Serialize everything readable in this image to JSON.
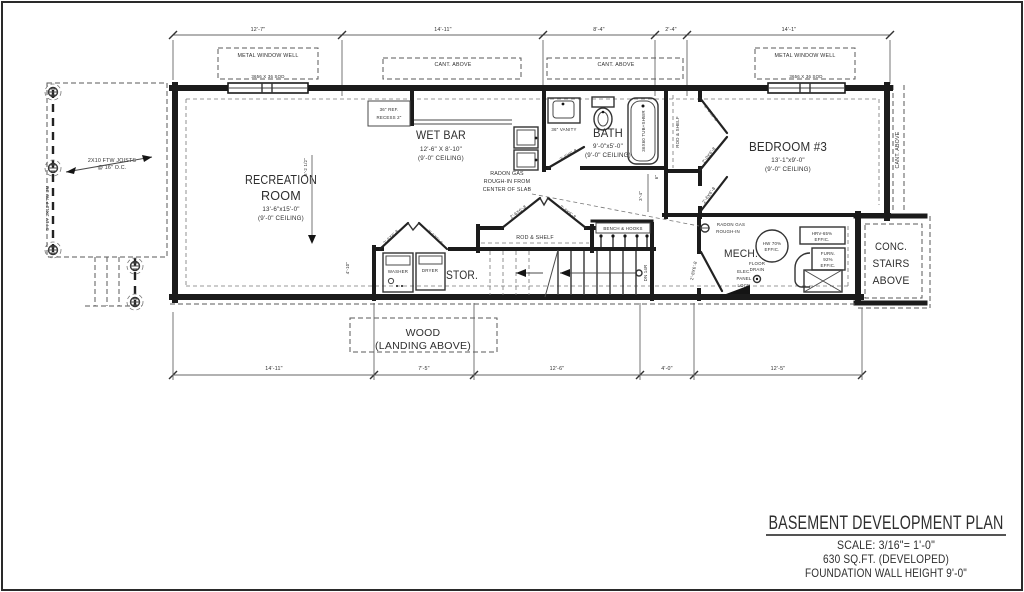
{
  "title_block": {
    "title": "BASEMENT DEVELOPMENT PLAN",
    "scale": "SCALE: 3/16\"= 1'-0\"",
    "area": "630 SQ.FT. (DEVELOPED)",
    "wall_height": "FOUNDATION WALL HEIGHT 9'-0\""
  },
  "dims": {
    "top": [
      "12'-7\"",
      "14'-11\"",
      "8'-4\"",
      "2'-4\"",
      "14'-1\""
    ],
    "bottom": [
      "14'-11\"",
      "7'-5\"",
      "12'-6\"",
      "4'-0\"",
      "12'-5\""
    ],
    "rec_height": "8'-2 1/2\"",
    "stor_width": "4'-10\"",
    "hall": "3'-4\"",
    "six": "6\""
  },
  "rooms": {
    "recreation": {
      "line1": "RECREATION",
      "line2": "ROOM",
      "size": "13'-6\"x15'-0\"",
      "ceiling": "(9'-0\" CEILING)"
    },
    "wetbar": {
      "name": "WET BAR",
      "size": "12'-6\" X 8'-10\"",
      "ceiling": "(9'-0\" CEILING)"
    },
    "bath": {
      "name": "BATH",
      "size": "9'-0\"x5'-0\"",
      "ceiling": "(9'-0\" CEILING)"
    },
    "bedroom": {
      "name": "BEDROOM #3",
      "size": "13'-1\"x9'-0\"",
      "ceiling": "(9'-0\" CEILING)"
    },
    "mech": {
      "name": "MECH."
    },
    "stor": {
      "name": "STOR."
    }
  },
  "ann": {
    "metal_window_well": "METAL WINDOW WELL",
    "cant_above": "CANT. ABOVE",
    "window_size": "3656 X 36 SOD",
    "joists_1": "2X10 FTW JOISTS",
    "joists_2": "@ 16\" O.C.",
    "beam": "3 PLY 2X10 FTW BM",
    "radon_slab_1": "RADON GAS",
    "radon_slab_2": "ROUGH-IN FROM",
    "radon_slab_3": "CENTER OF SLAB",
    "radon_mech_1": "RADON GAS",
    "radon_mech_2": "ROUGH-IN",
    "wood_1": "WOOD",
    "wood_2": "(LANDING ABOVE)",
    "conc_1": "CONC.",
    "conc_2": "STAIRS",
    "conc_3": "ABOVE",
    "dn": "DN 14R",
    "ref_1": "36\" REF.",
    "ref_2": "RECESS 2\"",
    "vanity": "36\" VANITY",
    "tub": "36X60 TUB+SHWR",
    "rod_shelf": "ROD & SHELF",
    "bench_hooks": "BENCH & HOOKS",
    "washer": "WASHER",
    "dryer": "DRYER",
    "hw_1": "HW 70%",
    "hw_2": "EFFIC.",
    "hrv_1": "HRV-65%",
    "hrv_2": "EFFIC.",
    "furn_1": "FURN.",
    "furn_2": "92%",
    "furn_3": "EFFIC.",
    "drain_1": "FLOOR",
    "drain_2": "DRAIN",
    "elec_1": "ELEC.",
    "elec_2": "PANEL",
    "elec_3": "LOCN"
  },
  "doors": {
    "d26": "2'-6X6'-8",
    "d20": "2'-0X6'-8",
    "d28": "2'-8X6'-8"
  },
  "colors": {
    "ink": "#2e2e2e",
    "paper": "#ffffff"
  }
}
